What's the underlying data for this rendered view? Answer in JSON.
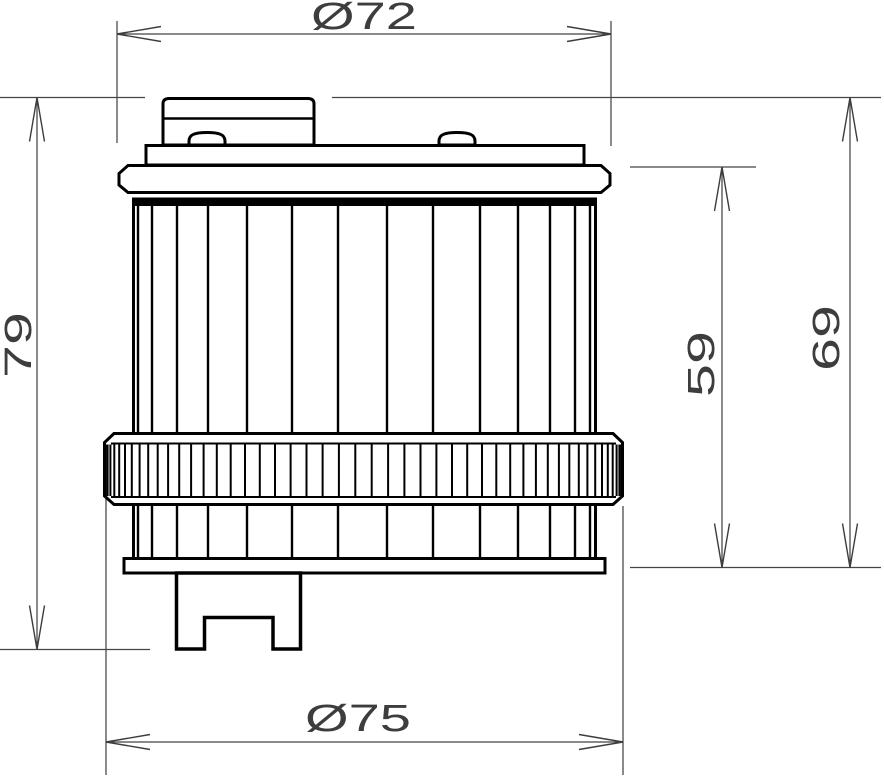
{
  "drawing": {
    "kind": "technical-drawing",
    "subject": "oil-filter-side-view",
    "background_color": "#ffffff",
    "outline_color": "#000000",
    "dimension_color": "#3d3d3d"
  },
  "dimensions": {
    "top_diameter": {
      "label": "Ø72",
      "value": 72,
      "symbol": "diameter",
      "orientation": "horizontal",
      "position": "top"
    },
    "bottom_diameter": {
      "label": "Ø75",
      "value": 75,
      "symbol": "diameter",
      "orientation": "horizontal",
      "position": "bottom"
    },
    "overall_height": {
      "label": "79",
      "value": 79,
      "symbol": "none",
      "orientation": "vertical",
      "position": "left"
    },
    "body_height": {
      "label": "59",
      "value": 59,
      "symbol": "none",
      "orientation": "vertical",
      "position": "right-inner"
    },
    "upper_height": {
      "label": "69",
      "value": 69,
      "symbol": "none",
      "orientation": "vertical",
      "position": "right-outer"
    }
  }
}
